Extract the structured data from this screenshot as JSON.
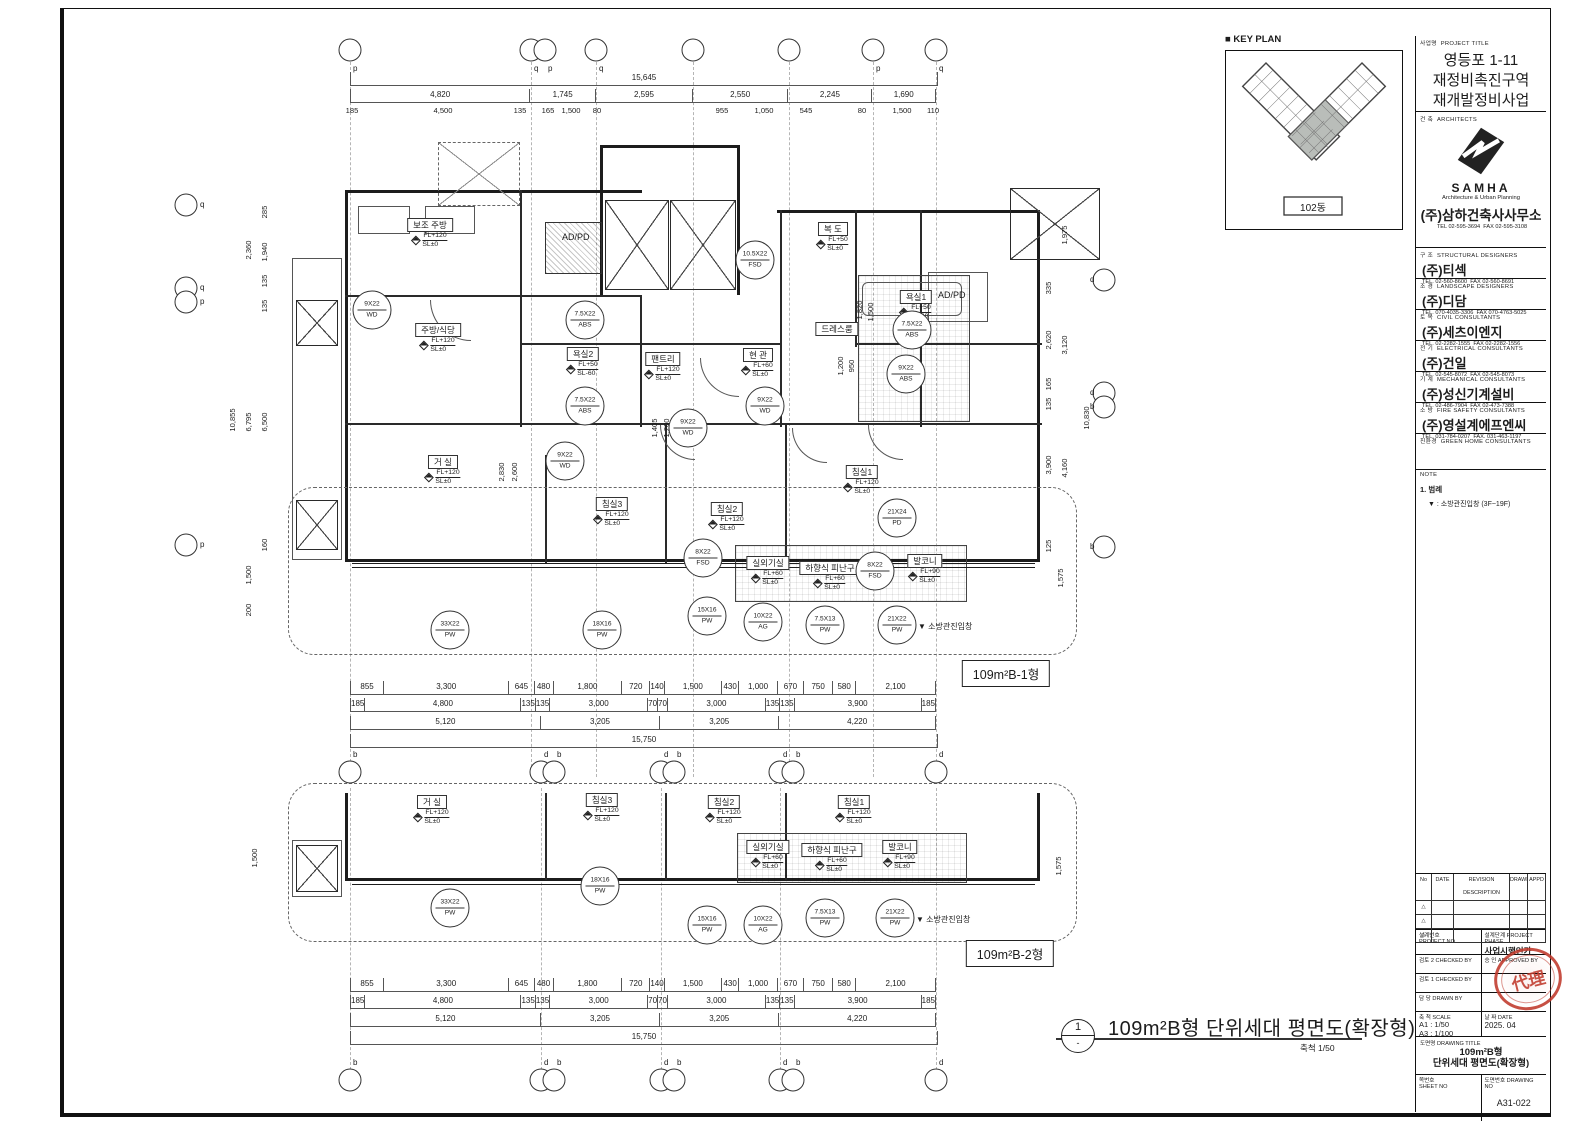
{
  "colors": {
    "line": "#1c1c1c",
    "stamp_red": "#c0392b"
  },
  "sheet": {
    "key_plan": {
      "title": "■ KEY PLAN",
      "building_label": "102동"
    },
    "footer": {
      "number": "1",
      "sub": "-",
      "title": "109m²B형 단위세대 평면도(확장형)",
      "scale": "축척 1/50"
    },
    "title_block": {
      "project": {
        "label_ko": "사업명",
        "label_en": "PROJECT TITLE",
        "line1": "영등포 1-11",
        "line2": "재정비촉진구역",
        "line3": "재개발정비사업"
      },
      "architects": {
        "label_ko": "건 축",
        "label_en": "ARCHITECTS",
        "logo": "SAMHA",
        "logo_sub": "Architecture & Urban Planning",
        "firm": "(주)삼하건축사사무소",
        "tel": "TEL 02-595-3694",
        "fax": "FAX 02-595-3108"
      },
      "consultants": [
        {
          "label_ko": "구 조",
          "label_en": "STRUCTURAL DESIGNERS",
          "firm": "(주)티섹",
          "tel": "TEL. 02-560-8600",
          "fax": "FAX 02-560-8691"
        },
        {
          "label_ko": "조 경",
          "label_en": "LANDSCAPE DESIGNERS",
          "firm": "(주)디담",
          "tel": "TEL. 070-4035-3306",
          "fax": "FAX 070-4763-5025"
        },
        {
          "label_ko": "토 목",
          "label_en": "CIVIL CONSULTANTS",
          "firm": "(주)세츠이엔지",
          "tel": "TEL. 02-2282-1555",
          "fax": "FAX 02-2282-1556"
        },
        {
          "label_ko": "전 기",
          "label_en": "ELECTRICAL CONSULTANTS",
          "firm": "(주)건일",
          "tel": "TEL. 02-545-8072",
          "fax": "FAX 02-545-8073"
        },
        {
          "label_ko": "기 계",
          "label_en": "MECHANICAL CONSULTANTS",
          "firm": "(주)성신기계설비",
          "tel": "TEL. 02-486-7904",
          "fax": "FAX 02-473-7388"
        },
        {
          "label_ko": "소 방",
          "label_en": "FIRE SAFETY CONSULTANTS",
          "firm": "(주)영설계에프엔씨",
          "tel": "TEL. 031-784-0207",
          "fax": "FAX. 031-463-1197"
        },
        {
          "label_ko": "친환경",
          "label_en": "GREEN HOME CONSULTANTS",
          "firm": "",
          "tel": "",
          "fax": ""
        }
      ],
      "note": {
        "label": "NOTE",
        "line1": "1. 범례",
        "line2": "▼ : 소방관진입창 (3F~19F)"
      },
      "revision": {
        "no": "No",
        "date": "DATE",
        "desc": "REVISION DESCRIPTION",
        "drawn": "DRAWN",
        "appd": "APPD",
        "mark": "△"
      },
      "meta": {
        "project_no_ko": "설계번호",
        "project_no_en": "PROJECT NO",
        "phase_ko": "설계단계",
        "phase_en": "PROJECT PHASE",
        "phase_value": "사업시행인가",
        "checked2_ko": "검토 2",
        "checked2_en": "CHECKED BY",
        "approved_ko": "승 인",
        "approved_en": "APPROVED BY",
        "stamp_text": "代理",
        "checked1_ko": "검토 1",
        "checked1_en": "CHECKED BY",
        "drawn_ko": "담 당",
        "drawn_en": "DRAWN BY",
        "scale_ko": "축 척",
        "scale_en": "SCALE",
        "scale_a1": "A1 : 1/50",
        "scale_a3": "A3 : 1/100",
        "date_ko": "날 짜",
        "date_en": "DATE",
        "date_value": "2025. 04",
        "title_ko": "도면명",
        "title_en": "DRAWING TITLE",
        "title_line1": "109m²B형",
        "title_line2": "단위세대 평면도(확장형)",
        "sheet_no_ko": "쪽번호",
        "sheet_no_en": "SHEET NO",
        "drawing_no_ko": "도면번호",
        "drawing_no_en": "DRAWING NO",
        "drawing_no_value": "A31-022"
      }
    }
  },
  "plan1": {
    "type_label": "109m²B-1형",
    "rooms": [
      {
        "name": "보조 주방",
        "fl": "FL+120",
        "sl": "SL±0"
      },
      {
        "name": "주방/식당",
        "fl": "FL+120",
        "sl": "SL±0"
      },
      {
        "name": "거 실",
        "fl": "FL+120",
        "sl": "SL±0"
      },
      {
        "name": "침실3",
        "fl": "FL+120",
        "sl": "SL±0"
      },
      {
        "name": "침실2",
        "fl": "FL+120",
        "sl": "SL±0"
      },
      {
        "name": "침실1",
        "fl": "FL+120",
        "sl": "SL±0"
      },
      {
        "name": "복 도",
        "fl": "FL+50",
        "sl": "SL±0"
      },
      {
        "name": "현 관",
        "fl": "FL+60",
        "sl": "SL±0"
      },
      {
        "name": "드레스룸",
        "fl": "",
        "sl": ""
      },
      {
        "name": "팬트리",
        "fl": "FL+120",
        "sl": "SL±0"
      },
      {
        "name": "욕실1",
        "fl": "FL+50",
        "sl": "SL-60"
      },
      {
        "name": "욕실2",
        "fl": "FL+50",
        "sl": "SL-60"
      },
      {
        "name": "실외기실",
        "fl": "FL+60",
        "sl": "SL±0"
      },
      {
        "name": "하향식 피난구",
        "fl": "FL+60",
        "sl": "SL±0"
      },
      {
        "name": "발코니",
        "fl": "FL+90",
        "sl": "SL±0"
      }
    ],
    "plain_labels": [
      "AD/PD",
      "AD/PD"
    ],
    "fire_note": "▼ 소방관진입창",
    "markers": [
      {
        "size": "9X22",
        "code": "WD"
      },
      {
        "size": "7.5X22",
        "code": "ABS"
      },
      {
        "size": "10.5X22",
        "code": "FSD"
      },
      {
        "size": "7.5X22",
        "code": "ABS"
      },
      {
        "size": "9X22",
        "code": "ABS"
      },
      {
        "size": "7.5X22",
        "code": "ABS"
      },
      {
        "size": "9X22",
        "code": "WD"
      },
      {
        "size": "9X22",
        "code": "WD"
      },
      {
        "size": "9X22",
        "code": "WD"
      },
      {
        "size": "21X24",
        "code": "PD"
      },
      {
        "size": "8X22",
        "code": "FSD"
      },
      {
        "size": "8X22",
        "code": "FSD"
      },
      {
        "size": "33X22",
        "code": "PW"
      },
      {
        "size": "18X16",
        "code": "PW"
      },
      {
        "size": "15X16",
        "code": "PW"
      },
      {
        "size": "10X22",
        "code": "AG"
      },
      {
        "size": "7.5X13",
        "code": "PW"
      },
      {
        "size": "21X22",
        "code": "PW"
      }
    ],
    "bubbles_top": [
      "p",
      "q",
      "p",
      "q",
      "",
      "",
      "p",
      "q"
    ],
    "bubbles_bottom": [
      "b",
      "d",
      "b",
      "d",
      "b",
      "d",
      "b",
      "d"
    ],
    "bubbles_left": [
      "q",
      "q",
      "p",
      "p"
    ],
    "bubbles_right": [
      "d",
      "d",
      "b",
      "b"
    ],
    "dims": {
      "top_total": "15,645",
      "top_row2": [
        "4,820",
        "1,745",
        "2,595",
        "2,550",
        "2,245",
        "1,690"
      ],
      "top_row3": [
        "185",
        "4,500",
        "135",
        "165",
        "1,500",
        "80",
        "955",
        "1,050",
        "545",
        "80",
        "1,500",
        "110"
      ],
      "bottom_row1": [
        "855",
        "3,300",
        "645",
        "480",
        "1,800",
        "720",
        "140",
        "1,500",
        "430",
        "1,000",
        "670",
        "750",
        "580",
        "2,100"
      ],
      "bottom_row2": [
        "185",
        "4,800",
        "135",
        "135",
        "3,000",
        "70",
        "70",
        "3,000",
        "135",
        "135",
        "3,900",
        "185"
      ],
      "bottom_row3": [
        "5,120",
        "3,205",
        "3,205",
        "4,220"
      ],
      "bottom_total": "15,750",
      "left_outer": "10,855",
      "left_col": [
        "2,360",
        "6,795",
        "1,500",
        "200"
      ],
      "left_inner": [
        "285",
        "1,940",
        "135",
        "135",
        "6,500",
        "160"
      ],
      "right_outer": "10,830",
      "right_col": [
        "1,975",
        "3,120",
        "4,160",
        "1,575"
      ],
      "right_inner": [
        "335",
        "2,620",
        "165",
        "135",
        "3,900",
        "125"
      ],
      "internal": [
        "2,830",
        "2,600",
        "1,405",
        "1,200",
        "1,820",
        "1,500",
        "1,200",
        "950"
      ]
    }
  },
  "plan2": {
    "type_label": "109m²B-2형",
    "rooms": [
      {
        "name": "거 실",
        "fl": "FL+120",
        "sl": "SL±0"
      },
      {
        "name": "침실3",
        "fl": "FL+120",
        "sl": "SL±0"
      },
      {
        "name": "침실2",
        "fl": "FL+120",
        "sl": "SL±0"
      },
      {
        "name": "침실1",
        "fl": "FL+120",
        "sl": "SL±0"
      },
      {
        "name": "실외기실",
        "fl": "FL+60",
        "sl": "SL±0"
      },
      {
        "name": "하향식 피난구",
        "fl": "FL+60",
        "sl": "SL±0"
      },
      {
        "name": "발코니",
        "fl": "FL+90",
        "sl": "SL±0"
      }
    ],
    "fire_note": "▼ 소방관진입창",
    "markers": [
      {
        "size": "33X22",
        "code": "PW"
      },
      {
        "size": "18X16",
        "code": "PW"
      },
      {
        "size": "15X16",
        "code": "PW"
      },
      {
        "size": "10X22",
        "code": "AG"
      },
      {
        "size": "7.5X13",
        "code": "PW"
      },
      {
        "size": "21X22",
        "code": "PW"
      }
    ],
    "bubbles_bottom": [
      "b",
      "d",
      "b",
      "d",
      "b",
      "d",
      "b",
      "d"
    ],
    "dims": {
      "bottom_row1": [
        "855",
        "3,300",
        "645",
        "480",
        "1,800",
        "720",
        "140",
        "1,500",
        "430",
        "1,000",
        "670",
        "750",
        "580",
        "2,100"
      ],
      "bottom_row2": [
        "185",
        "4,800",
        "135",
        "135",
        "3,000",
        "70",
        "70",
        "3,000",
        "135",
        "135",
        "3,900",
        "185"
      ],
      "bottom_row3": [
        "5,120",
        "3,205",
        "3,205",
        "4,220"
      ],
      "bottom_total": "15,750",
      "left_side": "1,500",
      "right_side": "1,575"
    }
  }
}
